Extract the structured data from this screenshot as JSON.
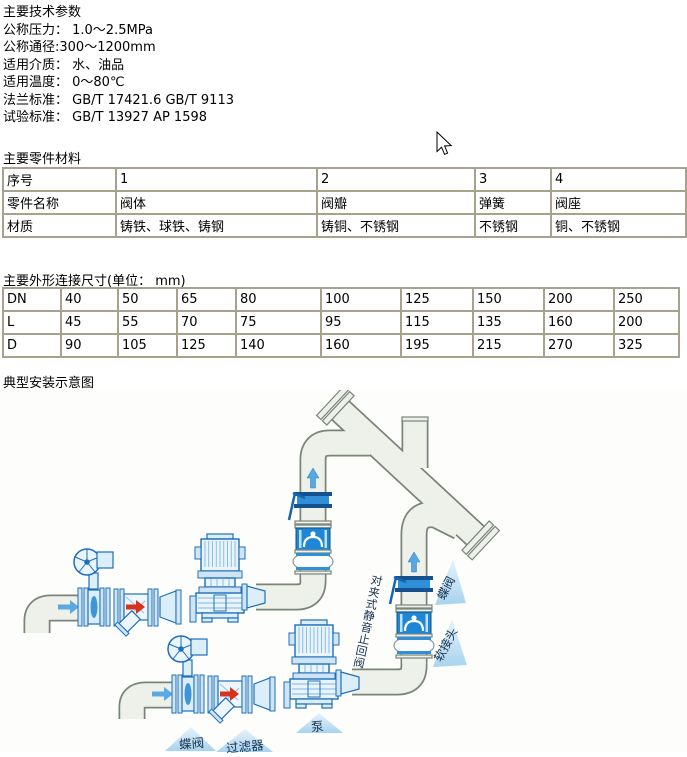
{
  "tech_params": {
    "title": "主要技术参数",
    "lines": [
      "公称压力： 1.0～2.5MPa",
      "公称通径:300～1200mm",
      "适用介质： 水、油品",
      "适用温度： 0～80℃",
      "法兰标准： GB/T 17421.6 GB/T 9113",
      "试验标准： GB/T 13927 AP 1598"
    ]
  },
  "materials_table": {
    "title": "主要零件材料",
    "rows": [
      [
        "序号",
        "1",
        "2",
        "3",
        "4"
      ],
      [
        "零件名称",
        "阀体",
        "阀瓣",
        "弹簧",
        "阀座"
      ],
      [
        "材质",
        "铸铁、球铁、铸钢",
        "铸铜、不锈钢",
        "不锈钢",
        "铜、不锈钢"
      ]
    ]
  },
  "dimensions_table": {
    "title": "主要外形连接尺寸(单位： mm)",
    "rows": [
      [
        "DN",
        "40",
        "50",
        "65",
        "80",
        "100",
        "125",
        "150",
        "200",
        "250"
      ],
      [
        "L",
        "45",
        "55",
        "70",
        "75",
        "95",
        "115",
        "135",
        "160",
        "200"
      ],
      [
        "D",
        "90",
        "105",
        "125",
        "140",
        "160",
        "195",
        "215",
        "270",
        "325"
      ]
    ]
  },
  "diagram": {
    "title": "典型安装示意图",
    "labels": {
      "check_valve": "对夹式静音止回阀",
      "butterfly_valve_right": "蝶阀",
      "flex_joint": "软接头",
      "butterfly_valve_bottom": "蝶阀",
      "strainer": "过滤器",
      "pump": "泵"
    },
    "colors": {
      "line_blue": "#1d6fba",
      "solid_blue": "#1d86d8",
      "pipe_fill": "#edf1e9",
      "pipe_stroke": "#7a857a",
      "label_triangle": "#aed6f1",
      "arrow_red": "#d8311c"
    }
  }
}
